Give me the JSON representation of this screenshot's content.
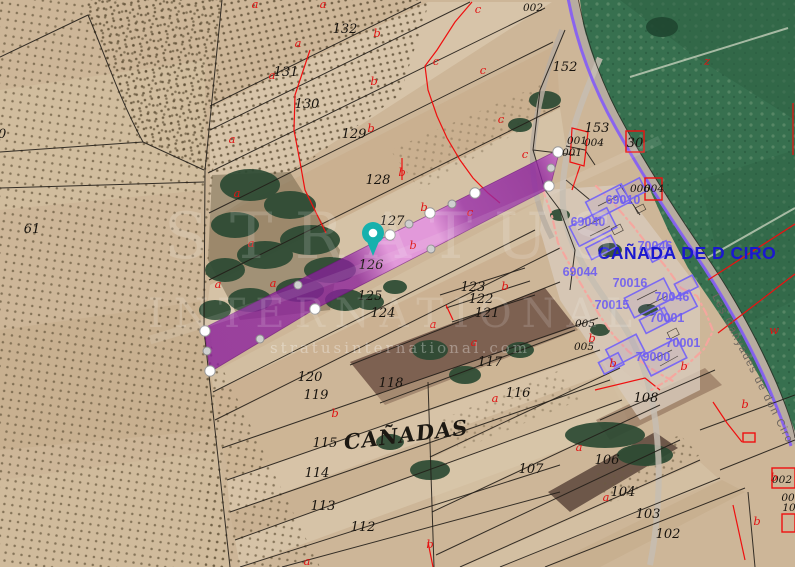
{
  "map_view": {
    "title_labels": {
      "district": "CAÑADAS",
      "village": "CAÑADA DE D CIRO",
      "road": "Les Canyades de don Ciro"
    },
    "watermark": {
      "line1": "STRATUS",
      "line2": "INTERNATIONAL",
      "line3": "stratusinternational.com"
    },
    "selected_parcel": {
      "number": "126",
      "fill_dark": "#8b1f9e",
      "fill_light": "#e792ea",
      "vertices": [
        [
          205,
          331
        ],
        [
          210,
          371
        ],
        [
          315,
          309
        ],
        [
          390,
          235
        ],
        [
          430,
          213
        ],
        [
          475,
          193
        ],
        [
          549,
          186
        ],
        [
          558,
          152
        ]
      ],
      "midpoints": [
        [
          260,
          339
        ],
        [
          298,
          285
        ],
        [
          207,
          351
        ],
        [
          409,
          224
        ],
        [
          452,
          204
        ],
        [
          431,
          249
        ],
        [
          551,
          168
        ]
      ]
    },
    "pin": {
      "color": "#16b1ad",
      "x": 373,
      "y": 233
    },
    "colors": {
      "cadastral_line": "#221e18",
      "red_line": "#ef0f0f",
      "urban_boundary": "#f7a59e",
      "road_line": "#8660f2",
      "road_fill": "#b7aca0",
      "building_blue": "#7b6af2",
      "blue_label": "#6f5ef0",
      "village_label": "#1a18cf",
      "green_field": "#37704f",
      "terrain": "#cdb698"
    },
    "parcel_numbers": [
      {
        "t": "132",
        "x": 345,
        "y": 33
      },
      {
        "t": "131",
        "x": 286,
        "y": 76
      },
      {
        "t": "130",
        "x": 307,
        "y": 108
      },
      {
        "t": "129",
        "x": 354,
        "y": 138
      },
      {
        "t": "128",
        "x": 378,
        "y": 184
      },
      {
        "t": "127",
        "x": 392,
        "y": 225
      },
      {
        "t": "126",
        "x": 371,
        "y": 269
      },
      {
        "t": "125",
        "x": 370,
        "y": 300
      },
      {
        "t": "124",
        "x": 383,
        "y": 317
      },
      {
        "t": "123",
        "x": 473,
        "y": 291
      },
      {
        "t": "122",
        "x": 481,
        "y": 303
      },
      {
        "t": "121",
        "x": 487,
        "y": 317
      },
      {
        "t": "120",
        "x": 310,
        "y": 381
      },
      {
        "t": "119",
        "x": 316,
        "y": 399
      },
      {
        "t": "118",
        "x": 391,
        "y": 387
      },
      {
        "t": "117",
        "x": 490,
        "y": 366
      },
      {
        "t": "116",
        "x": 518,
        "y": 397
      },
      {
        "t": "115",
        "x": 325,
        "y": 447
      },
      {
        "t": "114",
        "x": 317,
        "y": 477
      },
      {
        "t": "113",
        "x": 323,
        "y": 510
      },
      {
        "t": "112",
        "x": 363,
        "y": 531
      },
      {
        "t": "108",
        "x": 646,
        "y": 402
      },
      {
        "t": "107",
        "x": 531,
        "y": 473
      },
      {
        "t": "106",
        "x": 607,
        "y": 464
      },
      {
        "t": "104",
        "x": 623,
        "y": 496
      },
      {
        "t": "103",
        "x": 648,
        "y": 518
      },
      {
        "t": "102",
        "x": 668,
        "y": 538
      },
      {
        "t": "61",
        "x": 32,
        "y": 233
      },
      {
        "t": "90",
        "x": -2,
        "y": 138
      },
      {
        "t": "152",
        "x": 565,
        "y": 71
      },
      {
        "t": "153",
        "x": 597,
        "y": 132
      },
      {
        "t": "30",
        "x": 635,
        "y": 147
      }
    ],
    "code_labels": [
      {
        "t": "002",
        "x": 533,
        "y": 11
      },
      {
        "t": "001",
        "x": 577,
        "y": 144
      },
      {
        "t": "004",
        "x": 594,
        "y": 146
      },
      {
        "t": "001",
        "x": 572,
        "y": 156
      },
      {
        "t": "006",
        "x": 640,
        "y": 192
      },
      {
        "t": "004",
        "x": 654,
        "y": 192
      },
      {
        "t": "005",
        "x": 585,
        "y": 327
      },
      {
        "t": "005",
        "x": 584,
        "y": 350
      },
      {
        "t": "002",
        "x": 782,
        "y": 483
      },
      {
        "t": "00",
        "x": 788,
        "y": 501
      },
      {
        "t": "10",
        "x": 789,
        "y": 511
      }
    ],
    "red_letters": [
      {
        "t": "a",
        "x": 255,
        "y": 8
      },
      {
        "t": "a",
        "x": 323,
        "y": 8
      },
      {
        "t": "a",
        "x": 298,
        "y": 47
      },
      {
        "t": "a",
        "x": 272,
        "y": 79
      },
      {
        "t": "a",
        "x": 232,
        "y": 143
      },
      {
        "t": "a",
        "x": 237,
        "y": 197
      },
      {
        "t": "a",
        "x": 251,
        "y": 247
      },
      {
        "t": "a",
        "x": 218,
        "y": 288
      },
      {
        "t": "a",
        "x": 273,
        "y": 287
      },
      {
        "t": "a",
        "x": 433,
        "y": 328
      },
      {
        "t": "a",
        "x": 474,
        "y": 346
      },
      {
        "t": "a",
        "x": 495,
        "y": 402
      },
      {
        "t": "a",
        "x": 307,
        "y": 565
      },
      {
        "t": "a",
        "x": 579,
        "y": 451
      },
      {
        "t": "a",
        "x": 606,
        "y": 501
      },
      {
        "t": "b",
        "x": 377,
        "y": 37
      },
      {
        "t": "b",
        "x": 374,
        "y": 85
      },
      {
        "t": "b",
        "x": 371,
        "y": 132
      },
      {
        "t": "b",
        "x": 402,
        "y": 176
      },
      {
        "t": "b",
        "x": 424,
        "y": 211
      },
      {
        "t": "b",
        "x": 413,
        "y": 249
      },
      {
        "t": "b",
        "x": 505,
        "y": 290
      },
      {
        "t": "b",
        "x": 592,
        "y": 342
      },
      {
        "t": "b",
        "x": 613,
        "y": 367
      },
      {
        "t": "b",
        "x": 335,
        "y": 417
      },
      {
        "t": "b",
        "x": 430,
        "y": 548
      },
      {
        "t": "b",
        "x": 745,
        "y": 408
      },
      {
        "t": "b",
        "x": 757,
        "y": 525
      },
      {
        "t": "b",
        "x": 684,
        "y": 370
      },
      {
        "t": "b",
        "x": 774,
        "y": 481
      },
      {
        "t": "c",
        "x": 478,
        "y": 13
      },
      {
        "t": "c",
        "x": 436,
        "y": 65
      },
      {
        "t": "c",
        "x": 483,
        "y": 74
      },
      {
        "t": "c",
        "x": 501,
        "y": 123
      },
      {
        "t": "c",
        "x": 525,
        "y": 158
      },
      {
        "t": "c",
        "x": 470,
        "y": 216
      },
      {
        "t": "z",
        "x": 707,
        "y": 65
      },
      {
        "t": "w",
        "x": 774,
        "y": 334
      }
    ],
    "blue_codes": [
      {
        "t": "69010",
        "x": 623,
        "y": 204
      },
      {
        "t": "69040",
        "x": 588,
        "y": 226
      },
      {
        "t": "69044",
        "x": 580,
        "y": 276
      },
      {
        "t": "70046",
        "x": 655,
        "y": 250
      },
      {
        "t": "70016",
        "x": 630,
        "y": 287
      },
      {
        "t": "70046",
        "x": 672,
        "y": 301
      },
      {
        "t": "70015",
        "x": 612,
        "y": 309
      },
      {
        "t": "70001",
        "x": 667,
        "y": 322
      },
      {
        "t": "70001",
        "x": 683,
        "y": 347
      },
      {
        "t": "79000",
        "x": 653,
        "y": 361
      }
    ]
  }
}
